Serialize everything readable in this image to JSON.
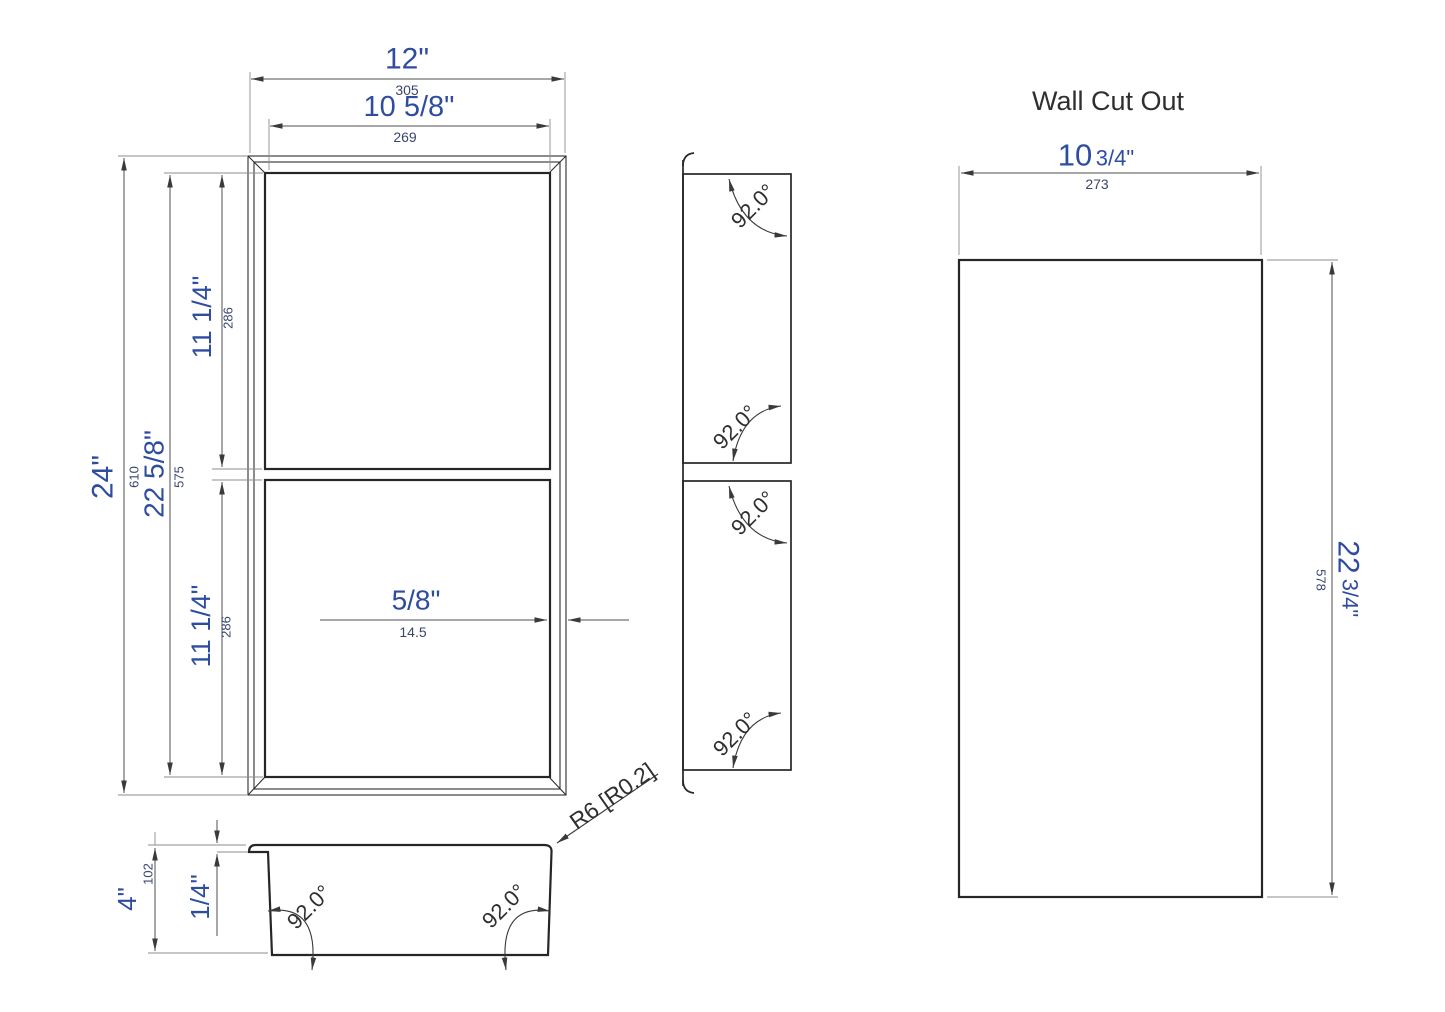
{
  "drawing": {
    "front_view": {
      "width_in": "12\"",
      "width_mm": "305",
      "opening_width_in": "10 5/8\"",
      "opening_width_mm": "269",
      "height_in": "24\"",
      "height_mm": "610",
      "opening_height_in": "22 5/8\"",
      "opening_height_mm": "575",
      "upper_opening_height_in": "11 1/4\"",
      "upper_opening_height_mm": "286",
      "lower_opening_height_in": "11 1/4\"",
      "lower_opening_height_mm": "286",
      "wall_thickness_in": "5/8\"",
      "wall_thickness_mm": "14.5"
    },
    "side_view": {
      "angle_upper_top": "92.0°",
      "angle_upper_bottom": "92.0°",
      "angle_lower_top": "92.0°",
      "angle_lower_bottom": "92.0°"
    },
    "section_view": {
      "depth_in": "4\"",
      "depth_mm": "102",
      "flange_thickness_in": "1/4\"",
      "angle_left": "92.0°",
      "angle_right": "92.0°",
      "corner_radius_callout": "R6 [R0.2]"
    },
    "wall_cutout": {
      "title": "Wall Cut Out",
      "width_in_whole": "10",
      "width_in_frac": "3/4\"",
      "width_mm": "273",
      "height_in_whole": "22",
      "height_in_frac": "3/4\"",
      "height_mm": "578"
    },
    "colors": {
      "inch_text": "#2e4da0",
      "mm_text": "#3b4570",
      "object_line": "#262626",
      "dimension_line": "#4f4f4f"
    }
  }
}
